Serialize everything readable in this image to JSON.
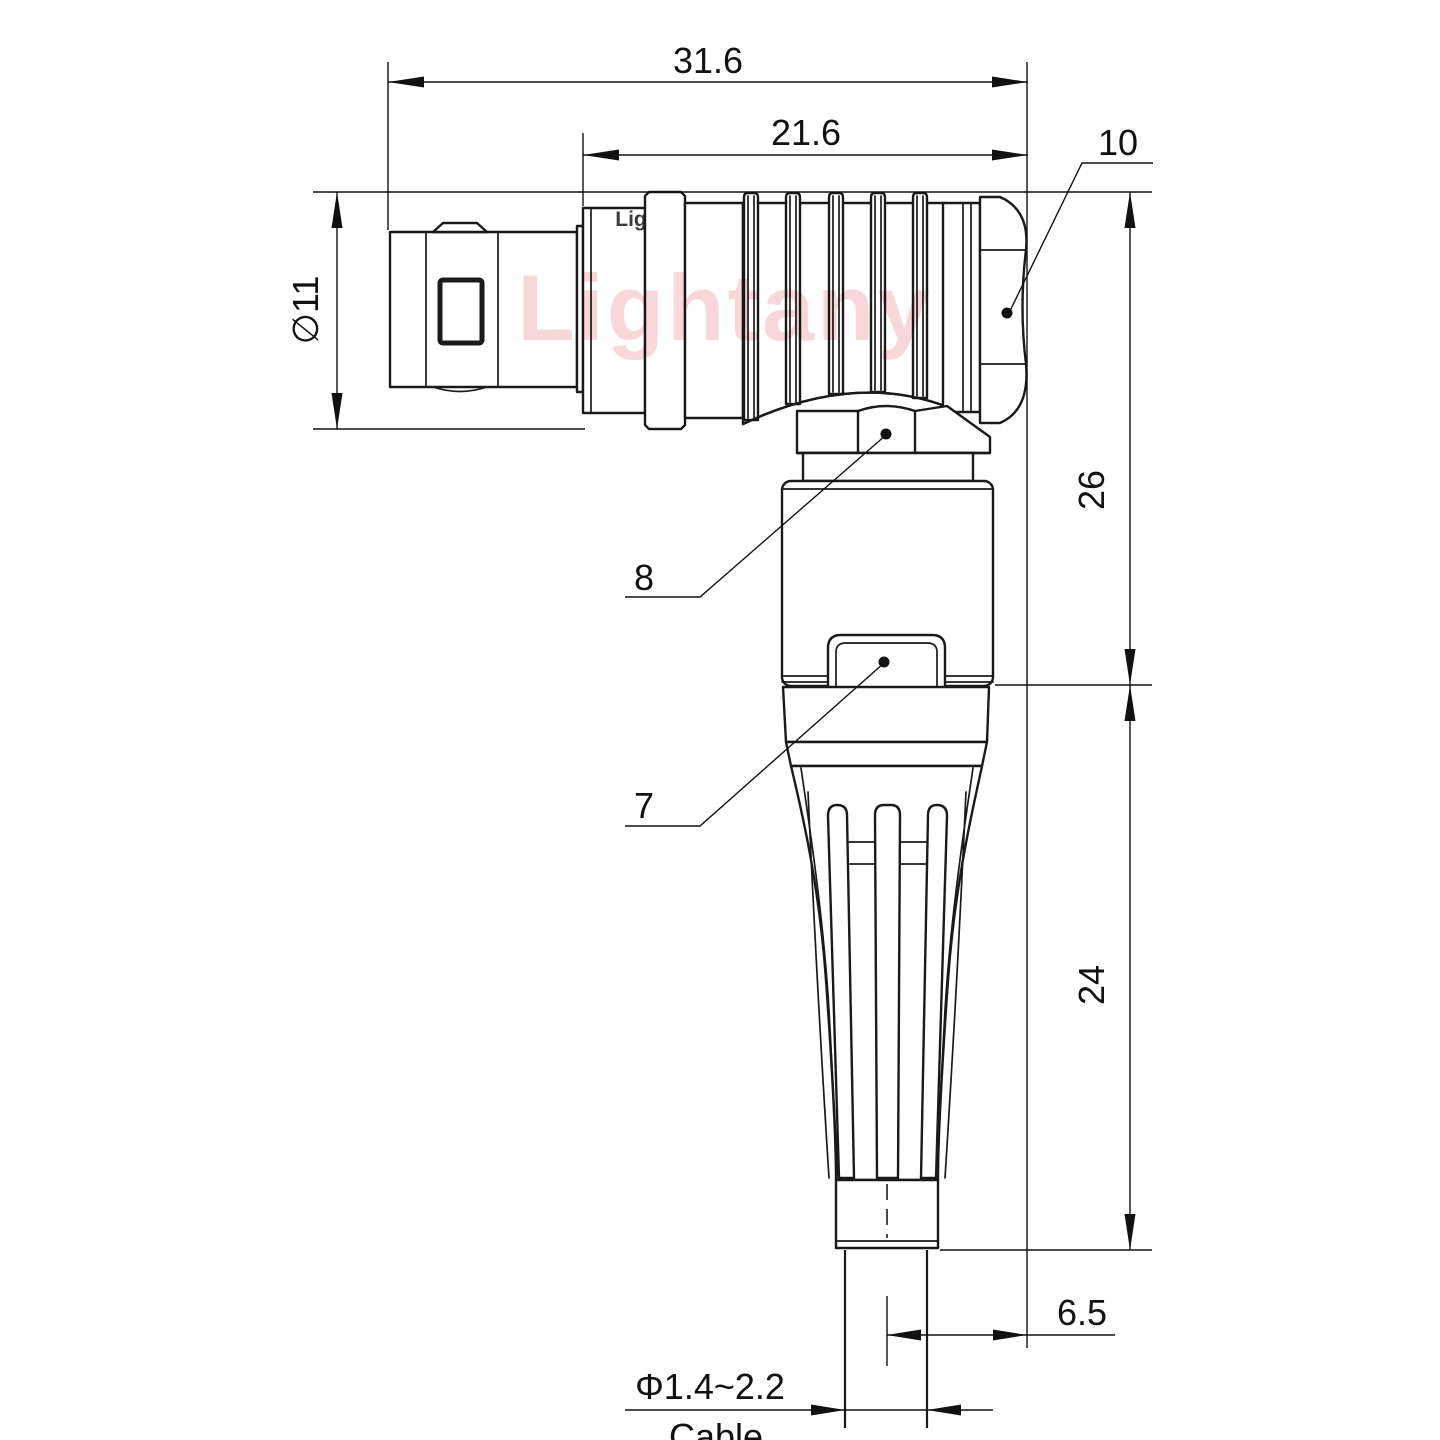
{
  "drawing": {
    "type": "technical-drawing",
    "subject": "right-angle push-pull circular connector plug, side view with cable exit",
    "watermark": "Lightany",
    "watermark_fragment": "Lig",
    "colors": {
      "line": "#1a1a1a",
      "watermark": "#f5c6c9",
      "background": "#ffffff"
    },
    "dims": {
      "overall_length": "31.6",
      "shell_length": "21.6",
      "front_diameter": "∅11",
      "upper_height": "26",
      "lower_height": "24",
      "cable_offset": "6.5",
      "cable_range": "Φ1.4~2.2",
      "cable_label": "Cable",
      "callout_rear_nut": "10",
      "callout_elbow_nut": "8",
      "callout_collet_nut": "7"
    }
  }
}
